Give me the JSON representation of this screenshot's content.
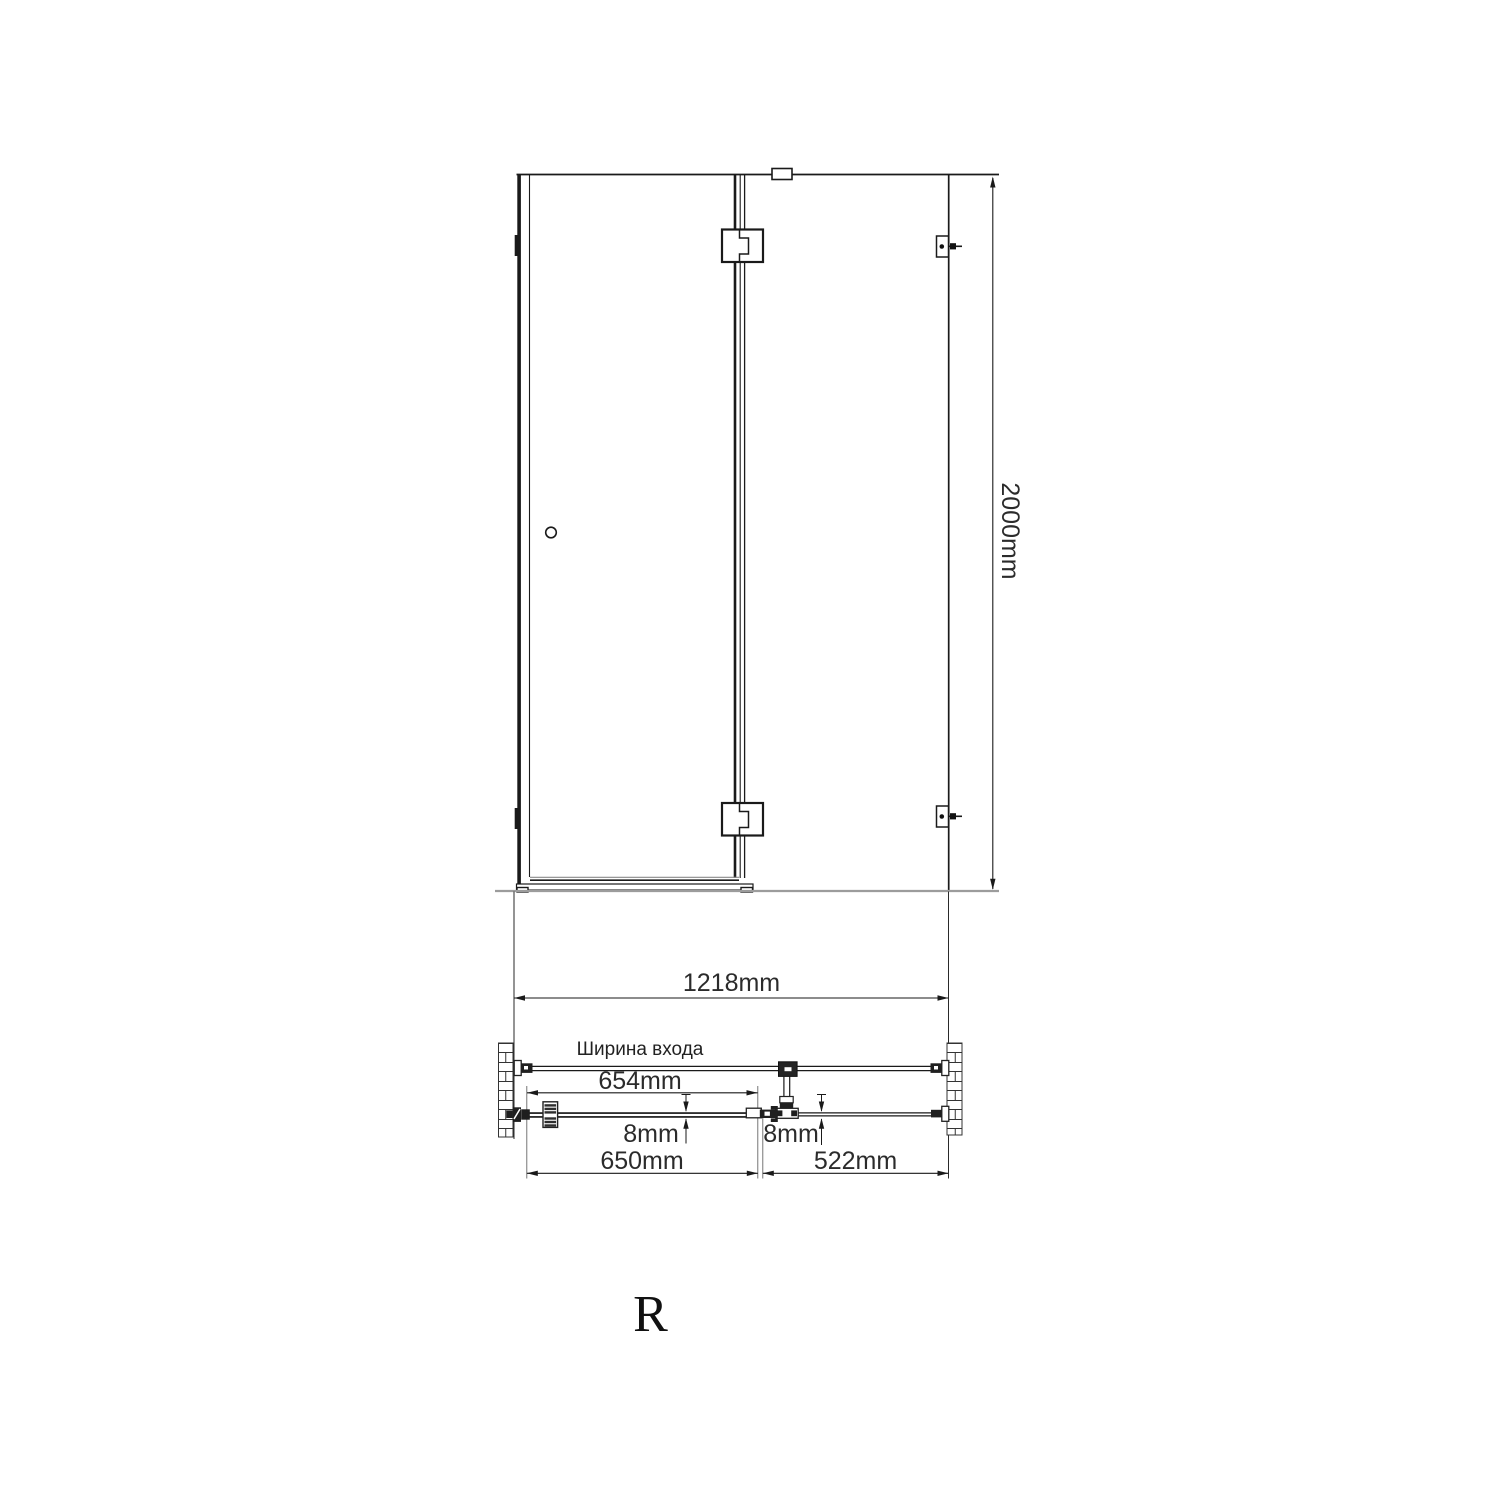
{
  "drawing": {
    "type": "shower-enclosure-technical-drawing",
    "orientation_label": "R",
    "front_view": {
      "height_label": "2000mm"
    },
    "plan_view": {
      "total_width_label": "1218mm",
      "entrance_label": "Ширина входа",
      "entrance_width_label": "654mm",
      "door_glass_thickness_label": "8mm",
      "panel_glass_thickness_label": "8mm",
      "door_width_label": "650mm",
      "panel_width_label": "522mm"
    },
    "colors": {
      "line": "#1a1a1a",
      "fitting_fill": "#1f1f1f",
      "ground_line": "#9c9c9c",
      "dimension_text": "#2b2b2b",
      "background": "#ffffff"
    }
  }
}
